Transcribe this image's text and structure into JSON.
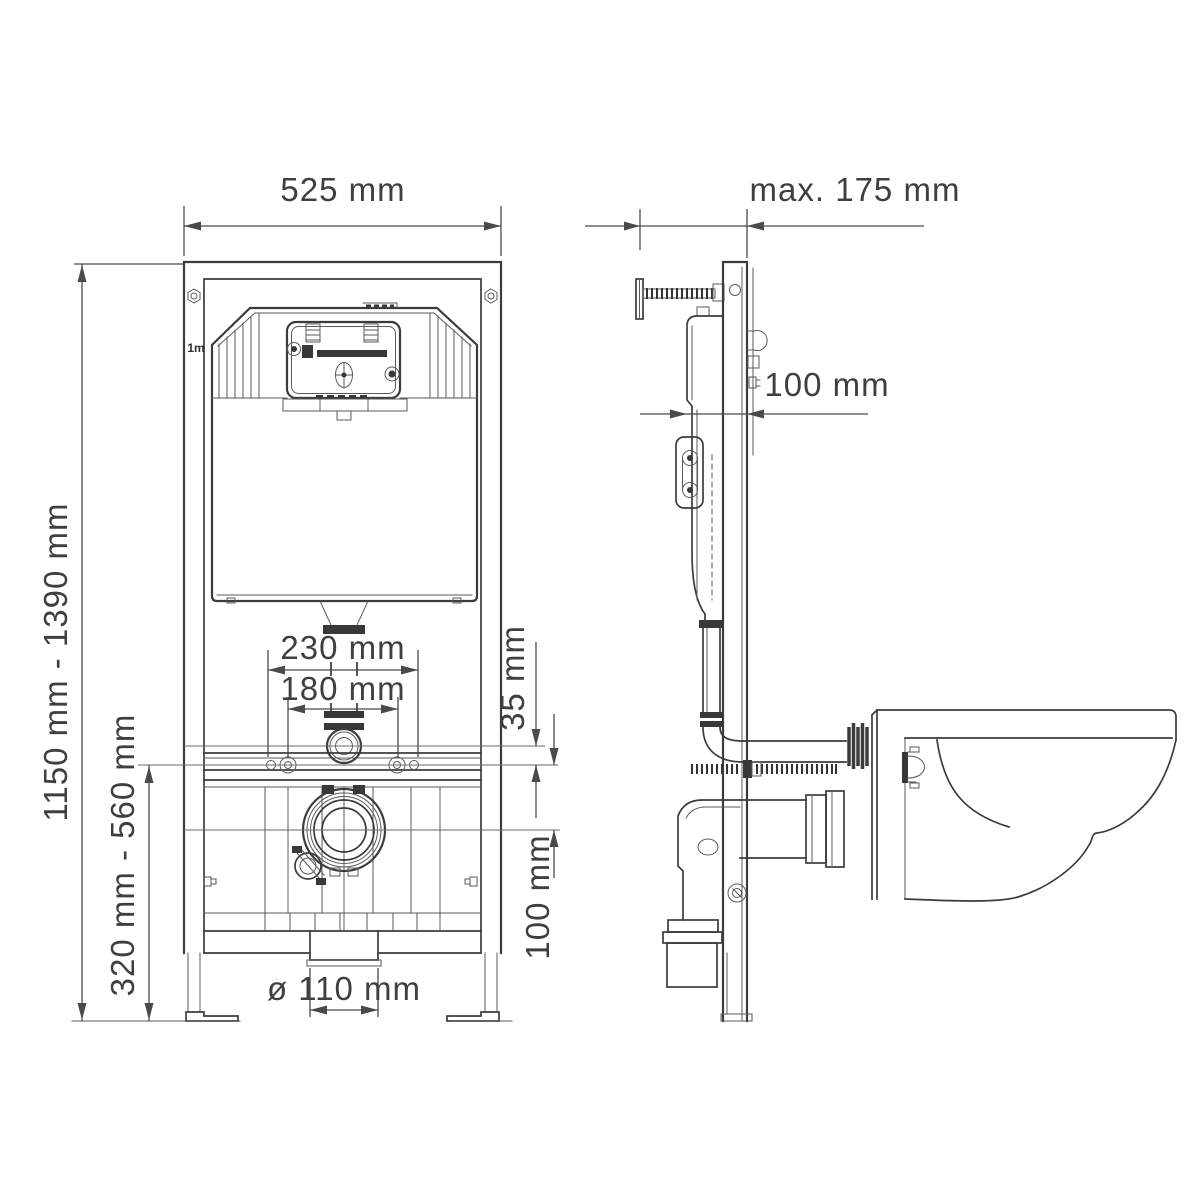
{
  "drawing": {
    "front_view": {
      "frame_width": "525 mm",
      "frame_height_range": "1150 mm - 1390 mm",
      "outlet_height_range": "320 mm - 560 mm",
      "bolt_spacing_outer": "230 mm",
      "bolt_spacing_inner": "180 mm",
      "flush_pipe_offset": "35 mm",
      "outlet_offset": "100 mm",
      "outlet_diameter": "ø 110 mm",
      "meter_mark": "1m"
    },
    "side_view": {
      "wall_distance_max": "max. 175 mm",
      "frame_depth": "100 mm"
    },
    "colors": {
      "line": "#3c3c3c",
      "dimension": "#4a4a4a",
      "dark_fill": "#383838",
      "background": "#ffffff"
    }
  }
}
